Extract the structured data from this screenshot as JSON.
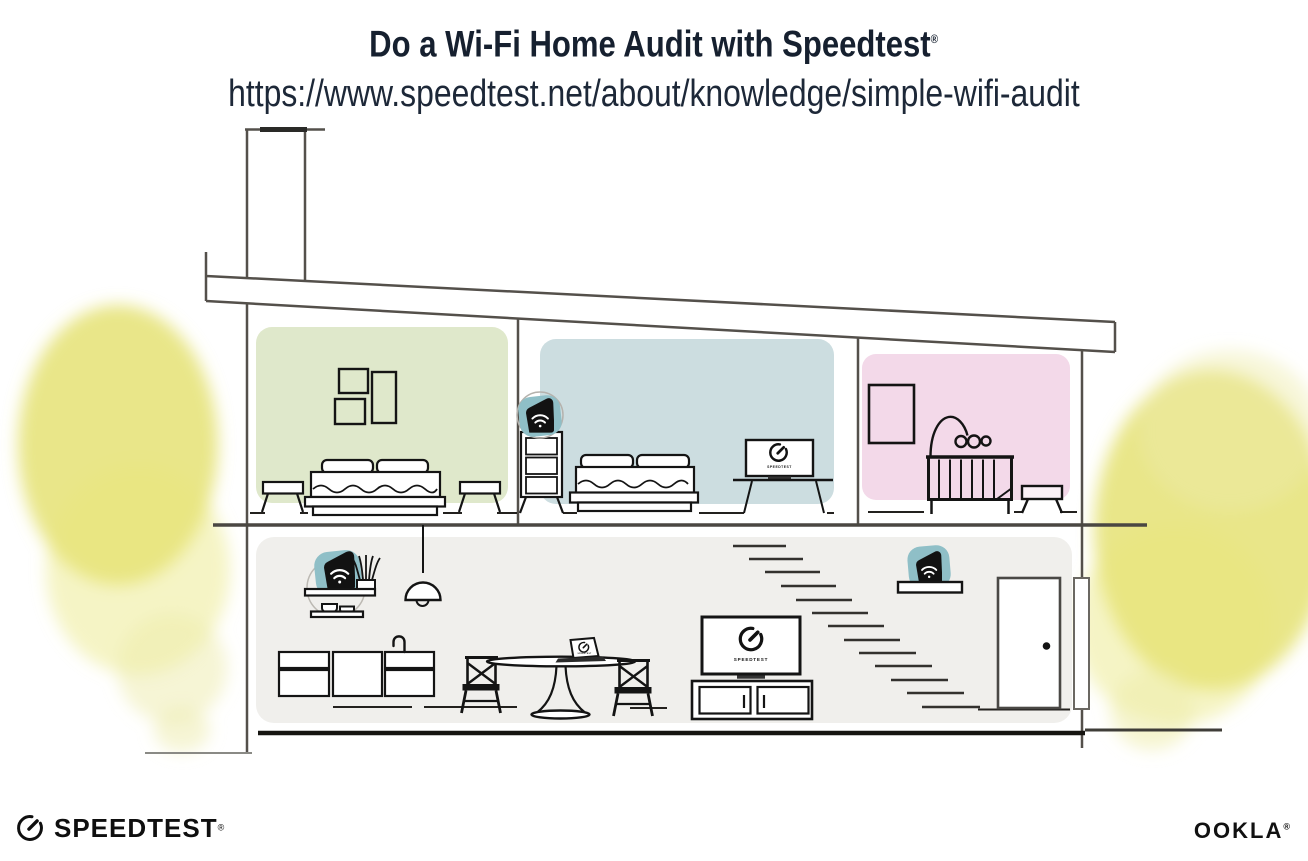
{
  "header": {
    "title": "Do a Wi-Fi Home Audit with Speedtest",
    "title_trademark": "®",
    "url": "https://www.speedtest.net/about/knowledge/simple-wifi-audit"
  },
  "illustration": {
    "screen_label": "SPEEDTEST",
    "colors": {
      "room_green": "#dfe8cb",
      "room_blue": "#ccdde0",
      "room_pink": "#f3d9e9",
      "room_gray": "#f0efec",
      "tree_yellow": "#e4e06a",
      "tree_yellow_mid": "#e9e67f",
      "tree_yellow_pale": "#eeecab",
      "device_teal": "#8fbfc7",
      "structure_line": "#54504b",
      "ink": "#141414"
    }
  },
  "footer": {
    "speedtest_wordmark": "SPEEDTEST",
    "speedtest_trademark": "®",
    "ookla_wordmark": "OOKLA",
    "ookla_trademark": "®"
  }
}
